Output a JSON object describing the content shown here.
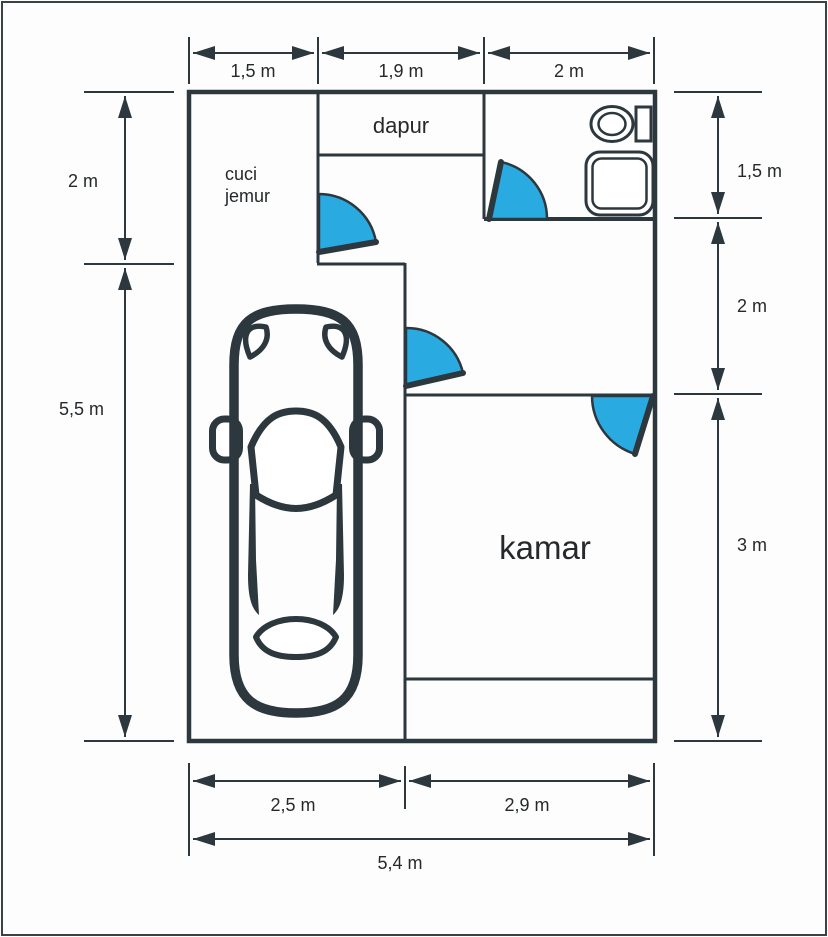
{
  "diagram": {
    "type": "floor-plan",
    "rooms": {
      "cuci_jemur": {
        "line1": "cuci",
        "line2": "jemur"
      },
      "dapur": {
        "label": "dapur"
      },
      "kamar": {
        "label": "kamar"
      }
    },
    "dimensions": {
      "top": [
        {
          "label": "1,5 m"
        },
        {
          "label": "1,9 m"
        },
        {
          "label": "2 m"
        }
      ],
      "left": [
        {
          "label": "2 m"
        },
        {
          "label": "5,5 m"
        }
      ],
      "right": [
        {
          "label": "1,5 m"
        },
        {
          "label": "2 m"
        },
        {
          "label": "3 m"
        }
      ],
      "bottom": [
        {
          "label": "2,5 m"
        },
        {
          "label": "2,9 m"
        }
      ],
      "bottom_total": {
        "label": "5,4 m"
      }
    },
    "colors": {
      "wall": "#2c383e",
      "door": "#29abe2",
      "text": "#26292b",
      "background": "#fdfdfd"
    }
  }
}
